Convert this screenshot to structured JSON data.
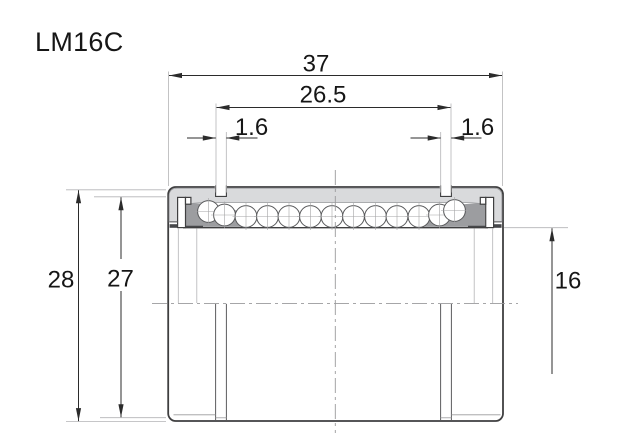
{
  "part": {
    "label": "LM16C"
  },
  "dimensions": {
    "overall_length": {
      "value": "37"
    },
    "groove_span": {
      "value": "26.5"
    },
    "groove_width_left": {
      "value": "1.6"
    },
    "groove_width_right": {
      "value": "1.6"
    },
    "outer_diameter": {
      "value": "28"
    },
    "groove_diameter": {
      "value": "27"
    },
    "bore_diameter": {
      "value": "16"
    }
  },
  "colors": {
    "background": "#ffffff",
    "outline": "#3f3f40",
    "shell": "#d9dadc",
    "retainer": "#9c9da0",
    "dim": "#2b2b2b",
    "ext": "#b4b4b6",
    "center": "#9a9a9c",
    "text": "#161616"
  }
}
